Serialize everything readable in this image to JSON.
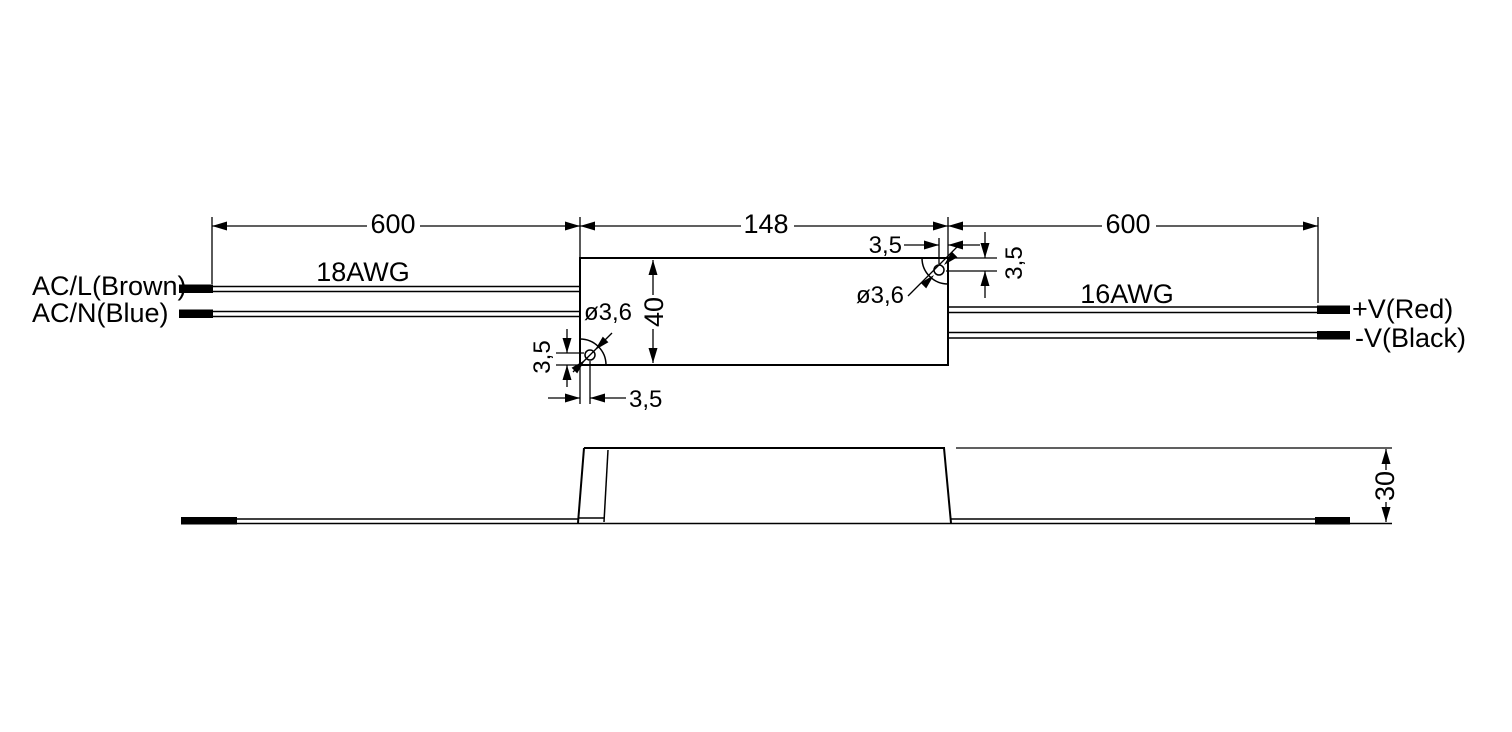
{
  "drawing": {
    "background": "#ffffff",
    "line_color": "#000000",
    "top_view": {
      "input": {
        "wire_gauge": "18AWG",
        "length_dim": "600",
        "wires": [
          {
            "label": "AC/L(Brown)"
          },
          {
            "label": "AC/N(Blue)"
          }
        ]
      },
      "body": {
        "length_dim": "148",
        "width_dim": "40",
        "holes": [
          {
            "position": "bottom-left",
            "diameter": "ø3,6",
            "offset_x": "3,5",
            "offset_y": "3,5"
          },
          {
            "position": "top-right",
            "diameter": "ø3,6",
            "offset_x": "3,5",
            "offset_y": "3,5"
          }
        ]
      },
      "output": {
        "wire_gauge": "16AWG",
        "length_dim": "600",
        "wires": [
          {
            "label": "+V(Red)"
          },
          {
            "label": "-V(Black)"
          }
        ]
      }
    },
    "side_view": {
      "height_dim": "30"
    }
  }
}
